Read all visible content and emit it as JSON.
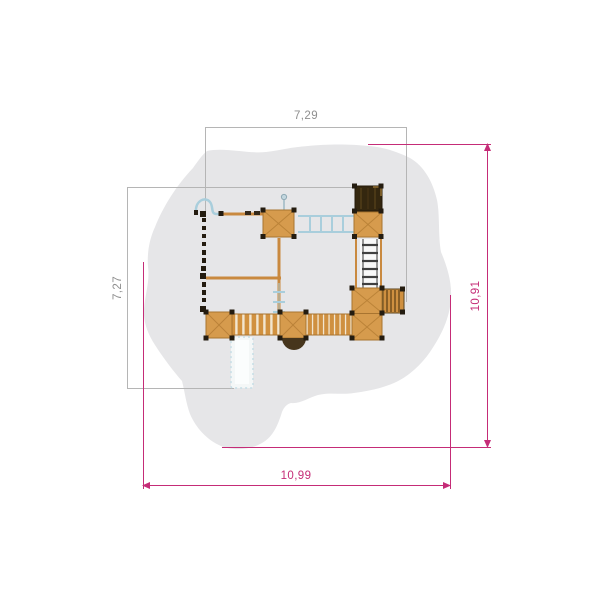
{
  "drawing": {
    "type": "playground-top-view-plan",
    "dimensions": {
      "structure": {
        "width_label": "7,29",
        "height_label": "7,27"
      },
      "safety_zone": {
        "width_label": "10,99",
        "height_label": "10,91"
      }
    },
    "colors": {
      "background": "#ffffff",
      "safety_zone_fill": "#e6e6e8",
      "structure_dim_line": "#b5b5b5",
      "structure_dim_text": "#8f8f8f",
      "safety_dim_line": "#c52c77",
      "wood": "#d69b4d",
      "wood_dark": "#a87430",
      "roof": "#34270f",
      "blue_accent": "#a9cedc",
      "post": "#241c10"
    },
    "components": [
      "safety-zone",
      "tower-roof",
      "tower-platform",
      "monkey-bars",
      "metal-ladder",
      "upper-platform",
      "access-steps",
      "wobble-bridge",
      "plank-bridge",
      "left-platform",
      "center-platform",
      "center-bottom-platform",
      "slide",
      "balcony-semicircle",
      "climbing-posts",
      "snake-pole",
      "flag-pole",
      "mini-ladder",
      "support-beams"
    ]
  }
}
